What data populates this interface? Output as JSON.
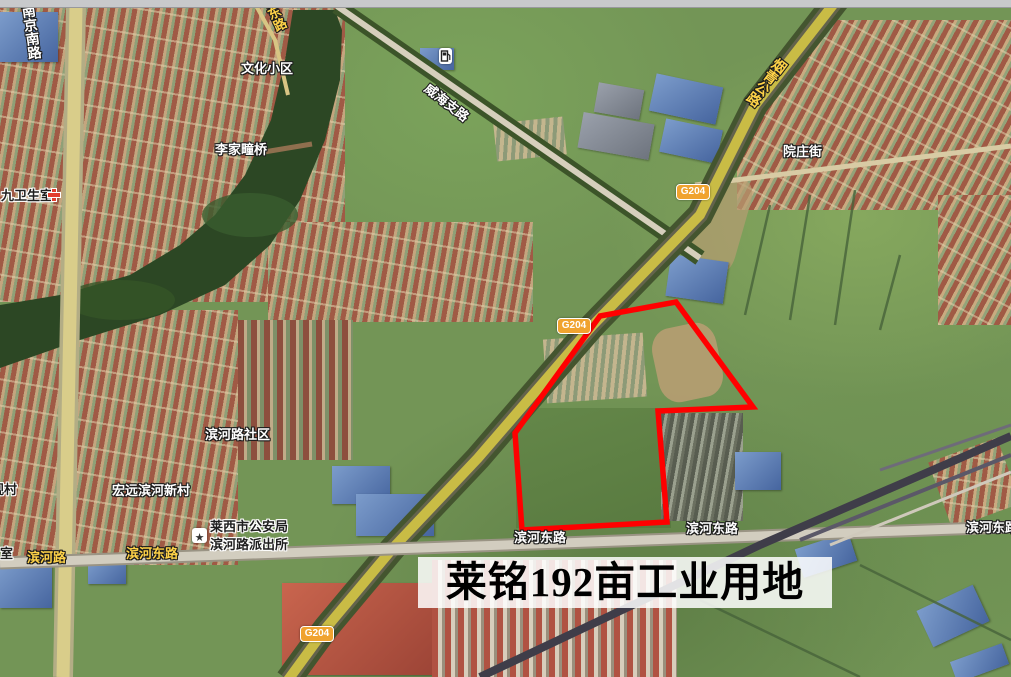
{
  "map_overlay": {
    "title": "莱铭192亩工业用地"
  },
  "parcel": {
    "points": "600,316 676,302 753,407 658,411 667,522 522,530 515,433",
    "outline_color": "#ff0000"
  },
  "roads": {
    "nanjing_south": "南京南路",
    "wenhua_east": "文化东路",
    "weihai_branch": "威海支路",
    "yanqing_highway": "烟青公路",
    "yuanzhuang_street": "院庄街",
    "binhe_road": "滨河路",
    "binhe_east_road": "滨河东路",
    "g204_badge": "G204"
  },
  "places": {
    "wenhua_community": "文化小区",
    "lijiatuan_bridge": "李家疃桥",
    "binhe_community": "滨河路社区",
    "hongyuan_village": "宏远滨河新村",
    "guancun_village": "观村",
    "clinic": "九卫生室",
    "partial_room": "室",
    "police_station_line1": "莱西市公安局",
    "police_station_line2": "滨河路派出所",
    "police_star": "★"
  },
  "colors": {
    "parcel_outline": "#ff0000",
    "g204_badge_bg": "#f0a32f",
    "road_label_gold": "#ffd348"
  }
}
